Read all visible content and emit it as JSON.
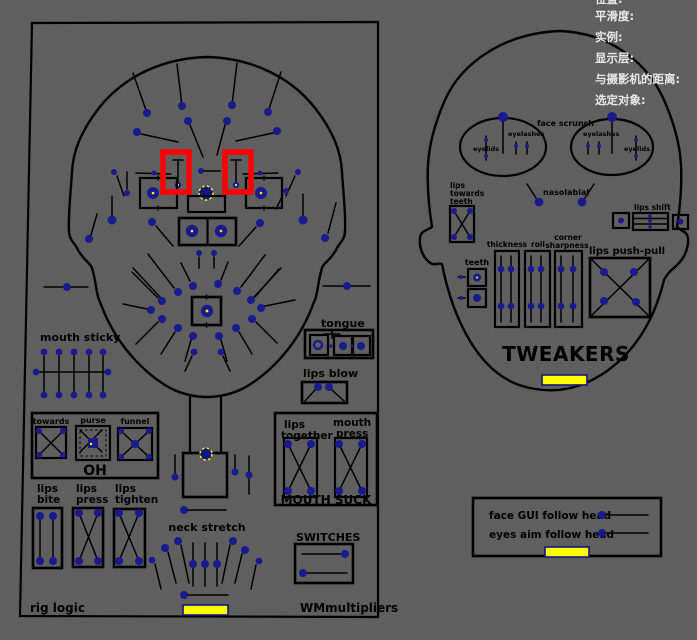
{
  "colors": {
    "background": "#5f5f5f",
    "outline": "#000000",
    "control_dot": "#1a1a8c",
    "selected_yellow": "#ffff00",
    "annotation_red": "#ff0000",
    "hud_text": "#e8e8e8"
  },
  "hud": {
    "lines": [
      "位置:",
      "平滑度:",
      "实例:",
      "显示层:",
      "与摄影机的距离:",
      "选定对象:"
    ]
  },
  "left_panel": {
    "mouth_sticky": "mouth sticky",
    "tongue": "tongue",
    "lips_blow": "lips blow",
    "towards": "towards",
    "purse": "purse",
    "funnel": "funnel",
    "oh_title": "OH",
    "lips": "lips",
    "bite": "bite",
    "press": "press",
    "tighten": "tighten",
    "together": "together",
    "mouth": "mouth",
    "mouth_suck": "MOUTH SUCK",
    "neck_stretch": "neck stretch",
    "switches": "SWITCHES",
    "rig_logic": "rig logic",
    "wm_multipliers": "WMmultipliers"
  },
  "tweakers_panel": {
    "title": "TWEAKERS",
    "face_scrunch": "face scrunch",
    "eyelids": "eyelids",
    "eyelashes": "eyelashes",
    "nasolabial": "nasolabial",
    "lips_word": "lips",
    "towards_word": "towards",
    "teeth_word": "teeth",
    "lips_shift": "lips shift",
    "teeth": "teeth",
    "thickness": "thickness",
    "roll": "roll",
    "corner": "corner",
    "sharpness": "sharpness",
    "lips_push_pull": "lips push-pull"
  },
  "follow_panel": {
    "face_gui": "face GUI follow head",
    "eyes_aim": "eyes aim follow head"
  }
}
